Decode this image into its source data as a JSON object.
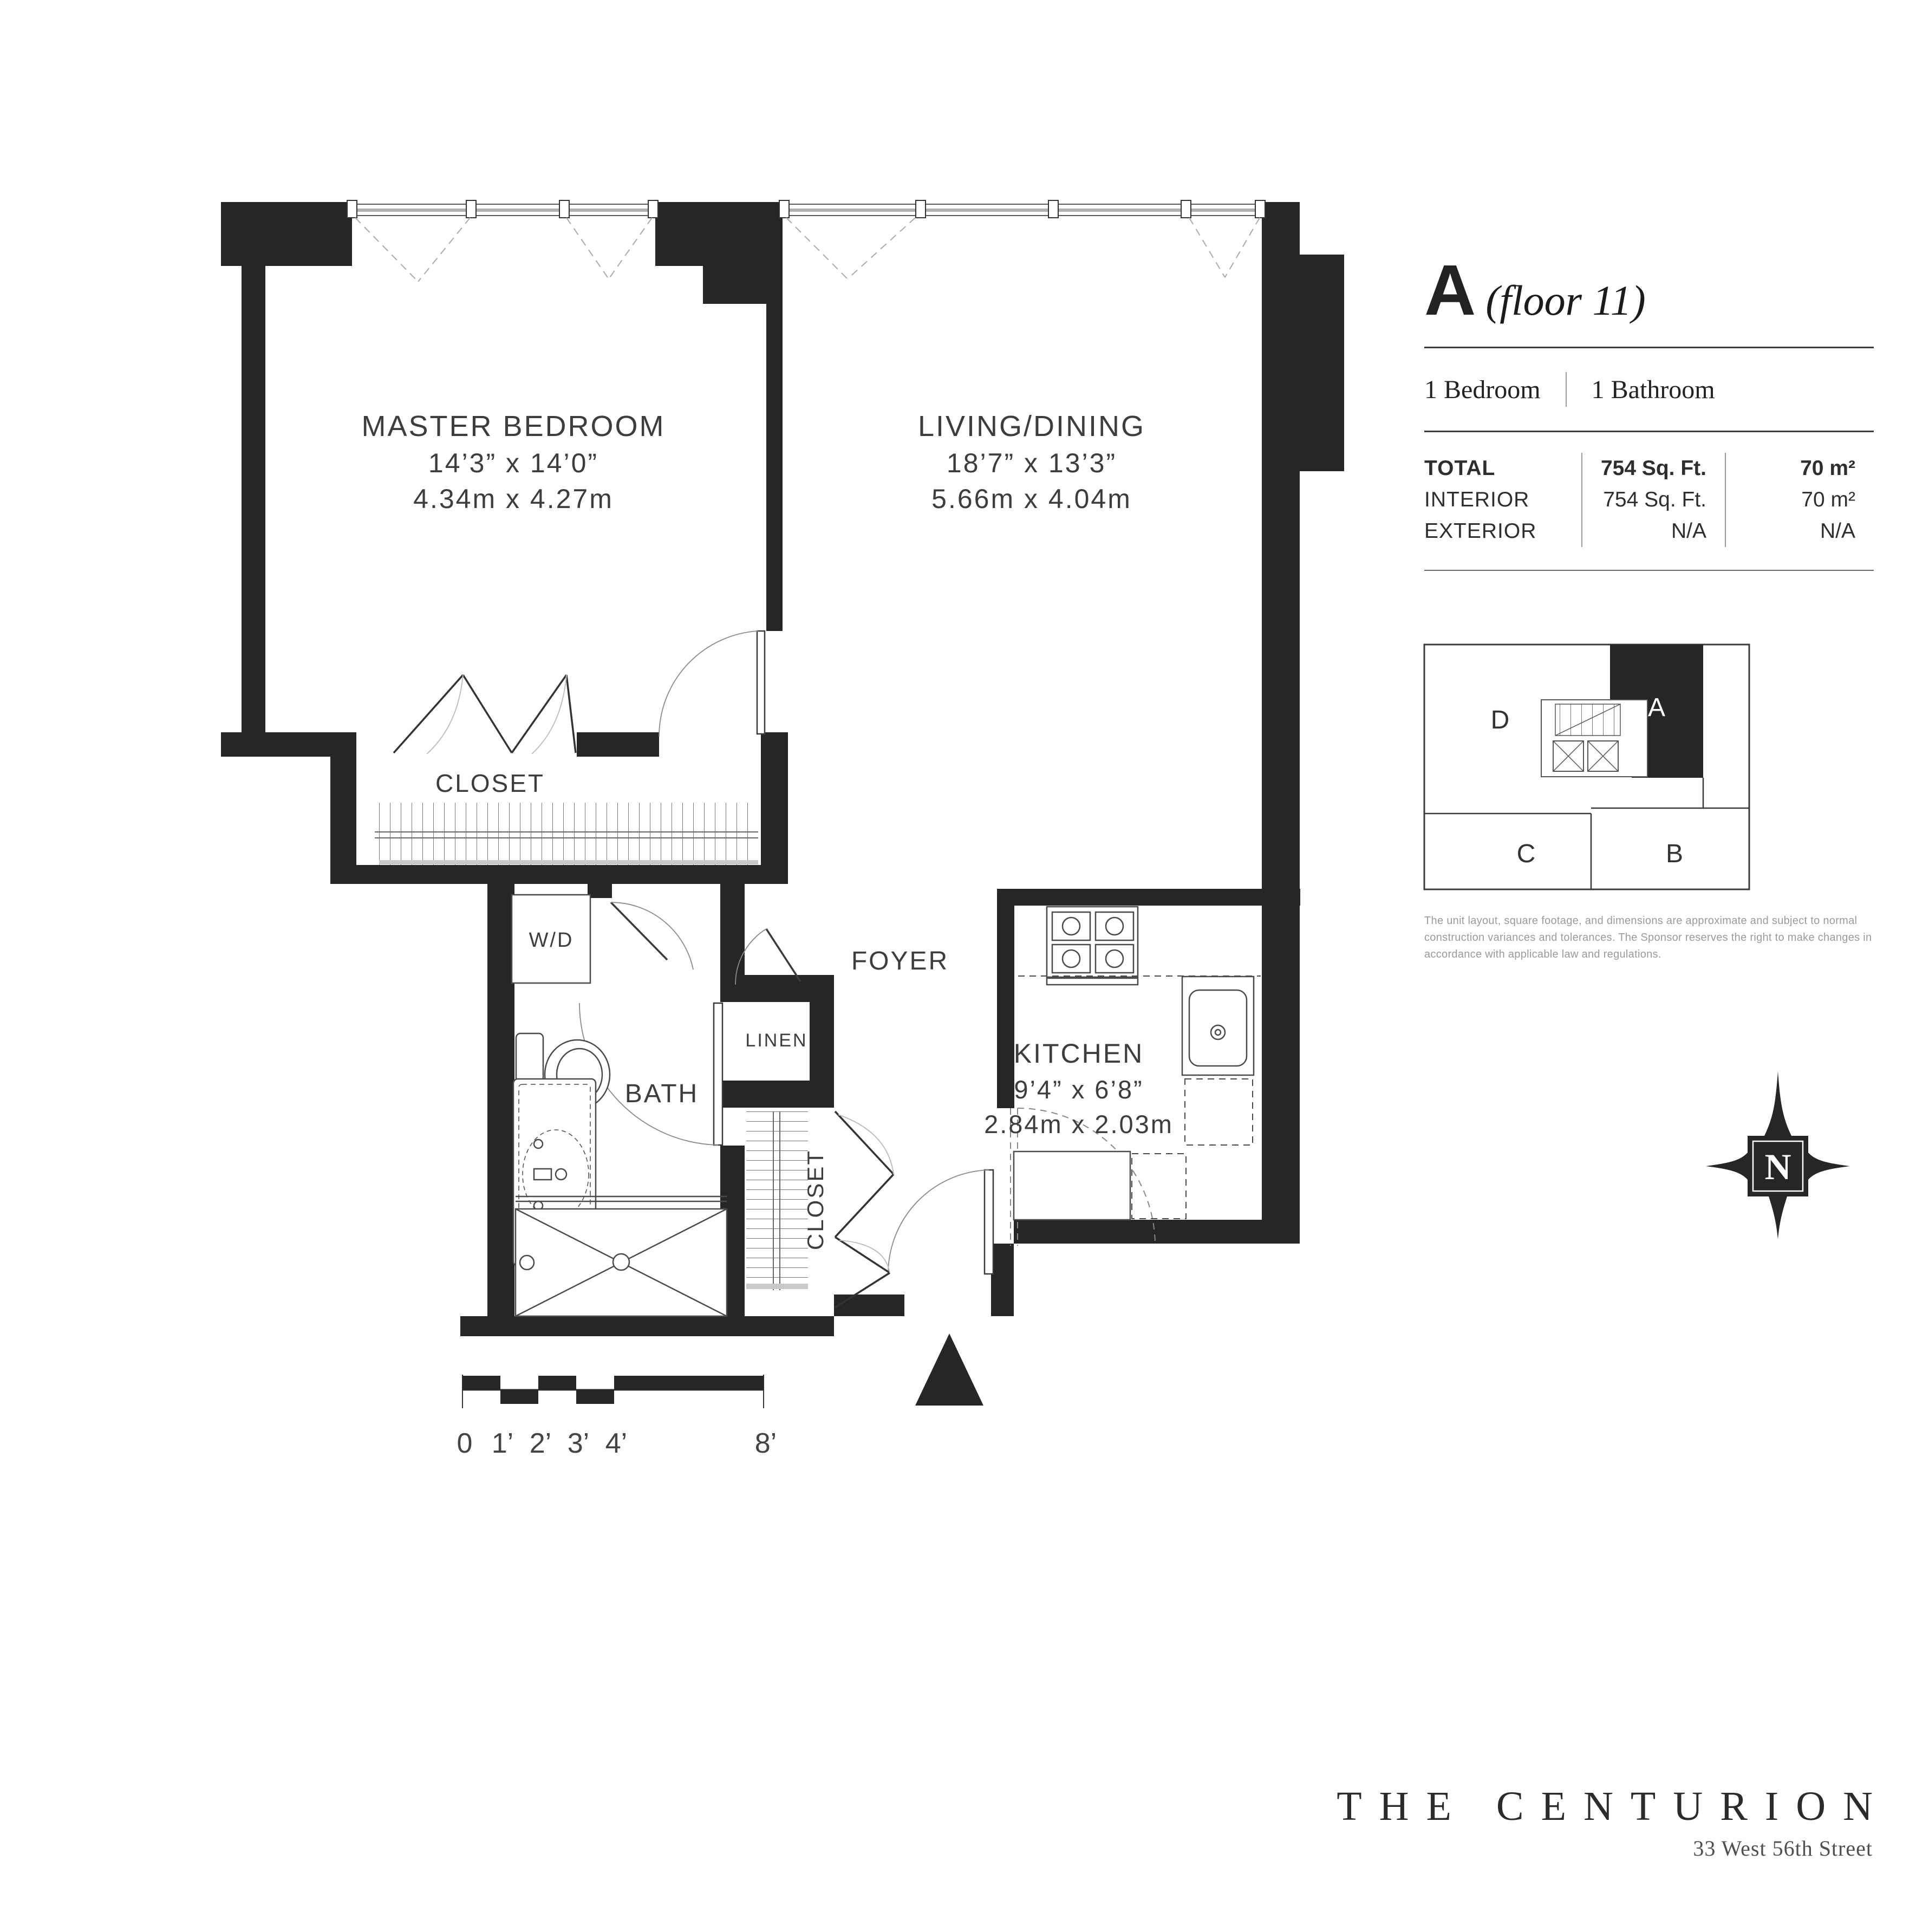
{
  "colors": {
    "wall": "#262626",
    "line": "#4a4a4a",
    "label": "#3d3d3d",
    "muted": "#9a9a9a"
  },
  "plan": {
    "rooms": {
      "master_bedroom": {
        "name": "MASTER BEDROOM",
        "imperial": "14’3” x 14’0”",
        "metric": "4.34m x 4.27m"
      },
      "living_dining": {
        "name": "LIVING/DINING",
        "imperial": "18’7” x 13’3”",
        "metric": "5.66m x 4.04m"
      },
      "kitchen": {
        "name": "KITCHEN",
        "imperial": "9’4” x 6’8”",
        "metric": "2.84m x 2.03m"
      }
    },
    "labels": {
      "bath": "BATH",
      "foyer": "FOYER",
      "linen": "LINEN",
      "washer_dryer": "W/D",
      "bedroom_closet": "CLOSET",
      "foyer_closet": "CLOSET"
    },
    "scale": [
      "0",
      "1’",
      "2’",
      "3’",
      "4’",
      "8’"
    ],
    "compass": "N"
  },
  "panel": {
    "unit_letter": "A",
    "floor_label": "(floor 11)",
    "bedrooms": "1 Bedroom",
    "bathrooms": "1 Bathroom",
    "table": {
      "rows": [
        {
          "label": "TOTAL",
          "sqft": "754 Sq. Ft.",
          "sqm": "70 m²"
        },
        {
          "label": "INTERIOR",
          "sqft": "754 Sq. Ft.",
          "sqm": "70 m²"
        },
        {
          "label": "EXTERIOR",
          "sqft": "N/A",
          "sqm": "N/A"
        }
      ]
    },
    "keyplan_units": [
      "D",
      "A",
      "C",
      "B"
    ],
    "disclaimer": "The unit layout, square footage, and dimensions are approximate and subject to normal construction variances and tolerances.  The Sponsor reserves the right to make changes in accordance with applicable law and regulations."
  },
  "footer": {
    "brand": "THE CENTURION",
    "address": "33 West 56th Street"
  }
}
